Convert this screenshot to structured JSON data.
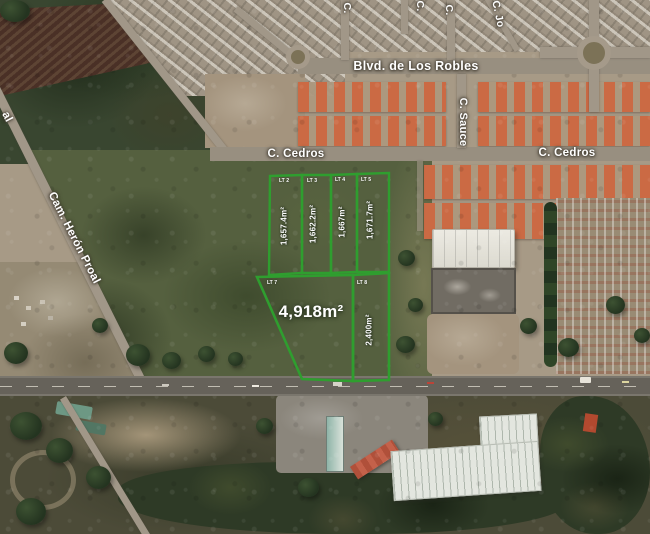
{
  "map": {
    "streets": {
      "blvd": "Blvd. de Los Robles",
      "cedros_left": "C. Cedros",
      "cedros_right": "C. Cedros",
      "sauce": "C. Sauce",
      "heron_proal": "Cam. Herón Proal",
      "heron_proal_partial": "al",
      "top_partial_1": "C.",
      "top_partial_2": "C.",
      "top_partial_3": "C.",
      "top_partial_jo": "C. Jo"
    },
    "parcels": {
      "outline_color": "#2f9e2f",
      "label_color": "#ffffff",
      "items": [
        {
          "id": "LT 2",
          "area": "1,657.4m²"
        },
        {
          "id": "LT 3",
          "area": "1,662.2m²"
        },
        {
          "id": "LT 4",
          "area": "1,667m²"
        },
        {
          "id": "LT 5",
          "area": "1,671.7m²"
        },
        {
          "id": "LT 7",
          "area": "4,918m²"
        },
        {
          "id": "LT 8",
          "area": "2,400m²"
        }
      ]
    }
  }
}
